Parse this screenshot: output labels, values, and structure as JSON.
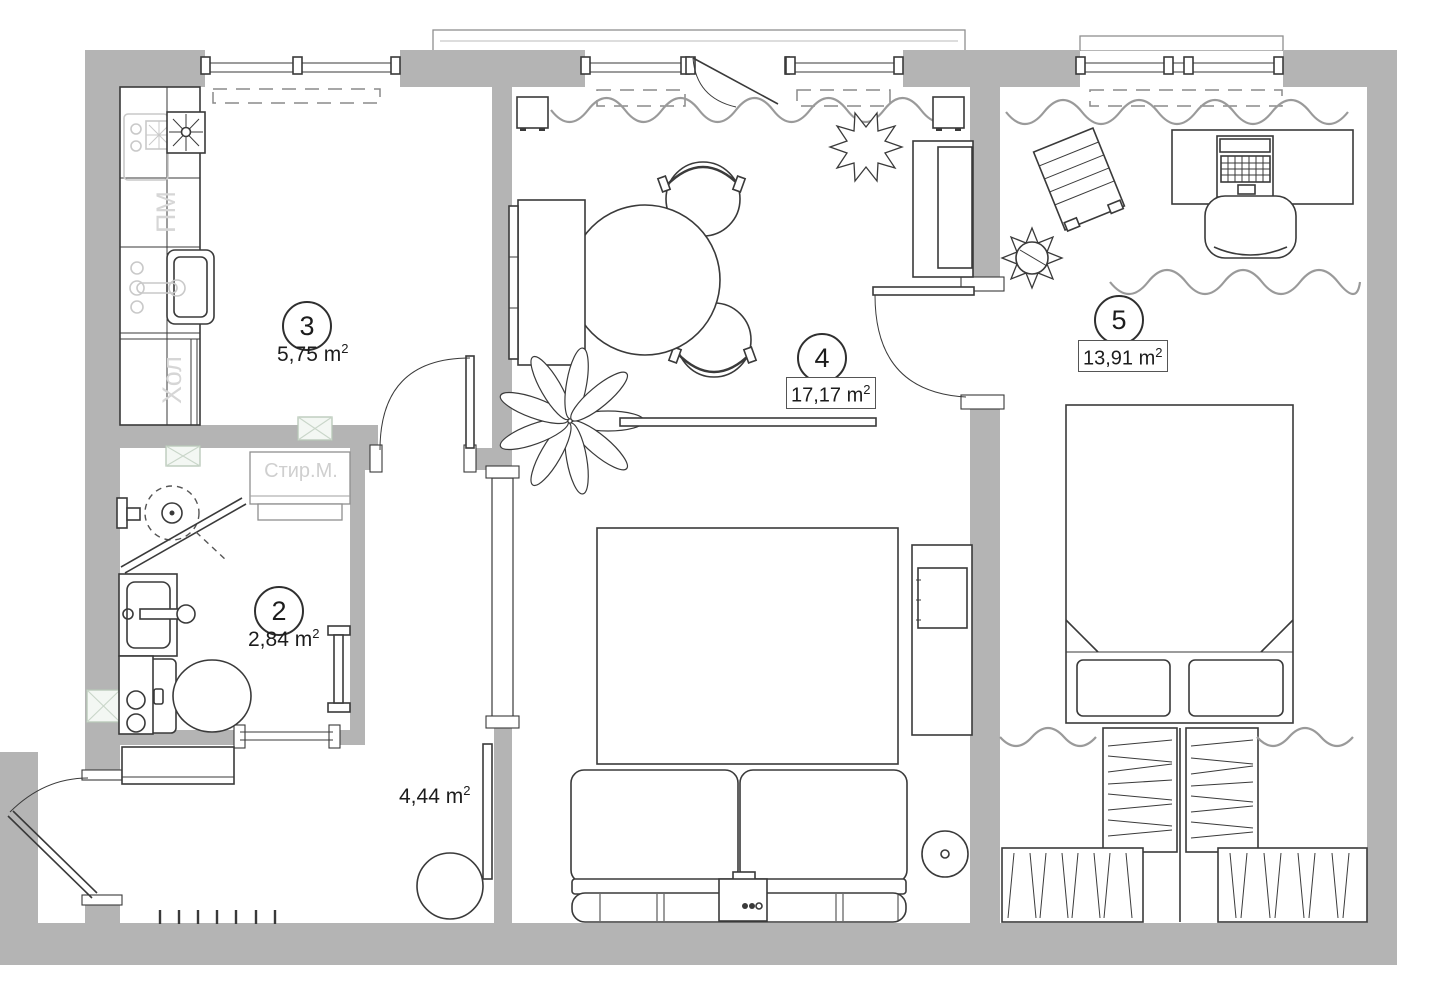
{
  "plan": {
    "rooms": [
      {
        "number": "3",
        "area": "5,75 m",
        "sup": "2"
      },
      {
        "number": "2",
        "area": "2,84 m",
        "sup": "2"
      },
      {
        "number": "4",
        "area": "17,17 m",
        "sup": "2"
      },
      {
        "number": "5",
        "area": "13,91 m",
        "sup": "2"
      },
      {
        "area": "4,44 m",
        "sup": "2"
      }
    ],
    "labels": {
      "dishwasher": "ПМ",
      "fridge": "Хол",
      "washing_machine": "Стир.М."
    },
    "colors": {
      "wall": "#b4b4b4",
      "line": "#3a3a3a",
      "ghost": "#c9c9c9",
      "curtain": "#9a9a9a",
      "vent": "#b7c7b7"
    },
    "icons": [
      "window-icon",
      "door-icon",
      "radiator-icon",
      "curtain-icon",
      "vent-icon",
      "stove-icon",
      "hob-icon",
      "kitchen-sink-icon",
      "dishwasher-icon",
      "fridge-icon",
      "dining-table-icon",
      "chair-icon",
      "shower-icon",
      "washbasin-icon",
      "toilet-icon",
      "washing-machine-icon",
      "towel-rail-icon",
      "wardrobe-icon",
      "coat-hooks-icon",
      "pouf-icon",
      "mirror-icon",
      "sideboard-icon",
      "speaker-icon",
      "plant-icon",
      "shelf-icon",
      "cabinet-icon",
      "sofa-bed-icon",
      "tv-icon",
      "tv-bench-icon",
      "side-table-icon",
      "tv-console-icon",
      "desk-icon",
      "laptop-icon",
      "office-chair-icon",
      "drying-rack-icon",
      "bed-icon",
      "closet-icon"
    ]
  }
}
